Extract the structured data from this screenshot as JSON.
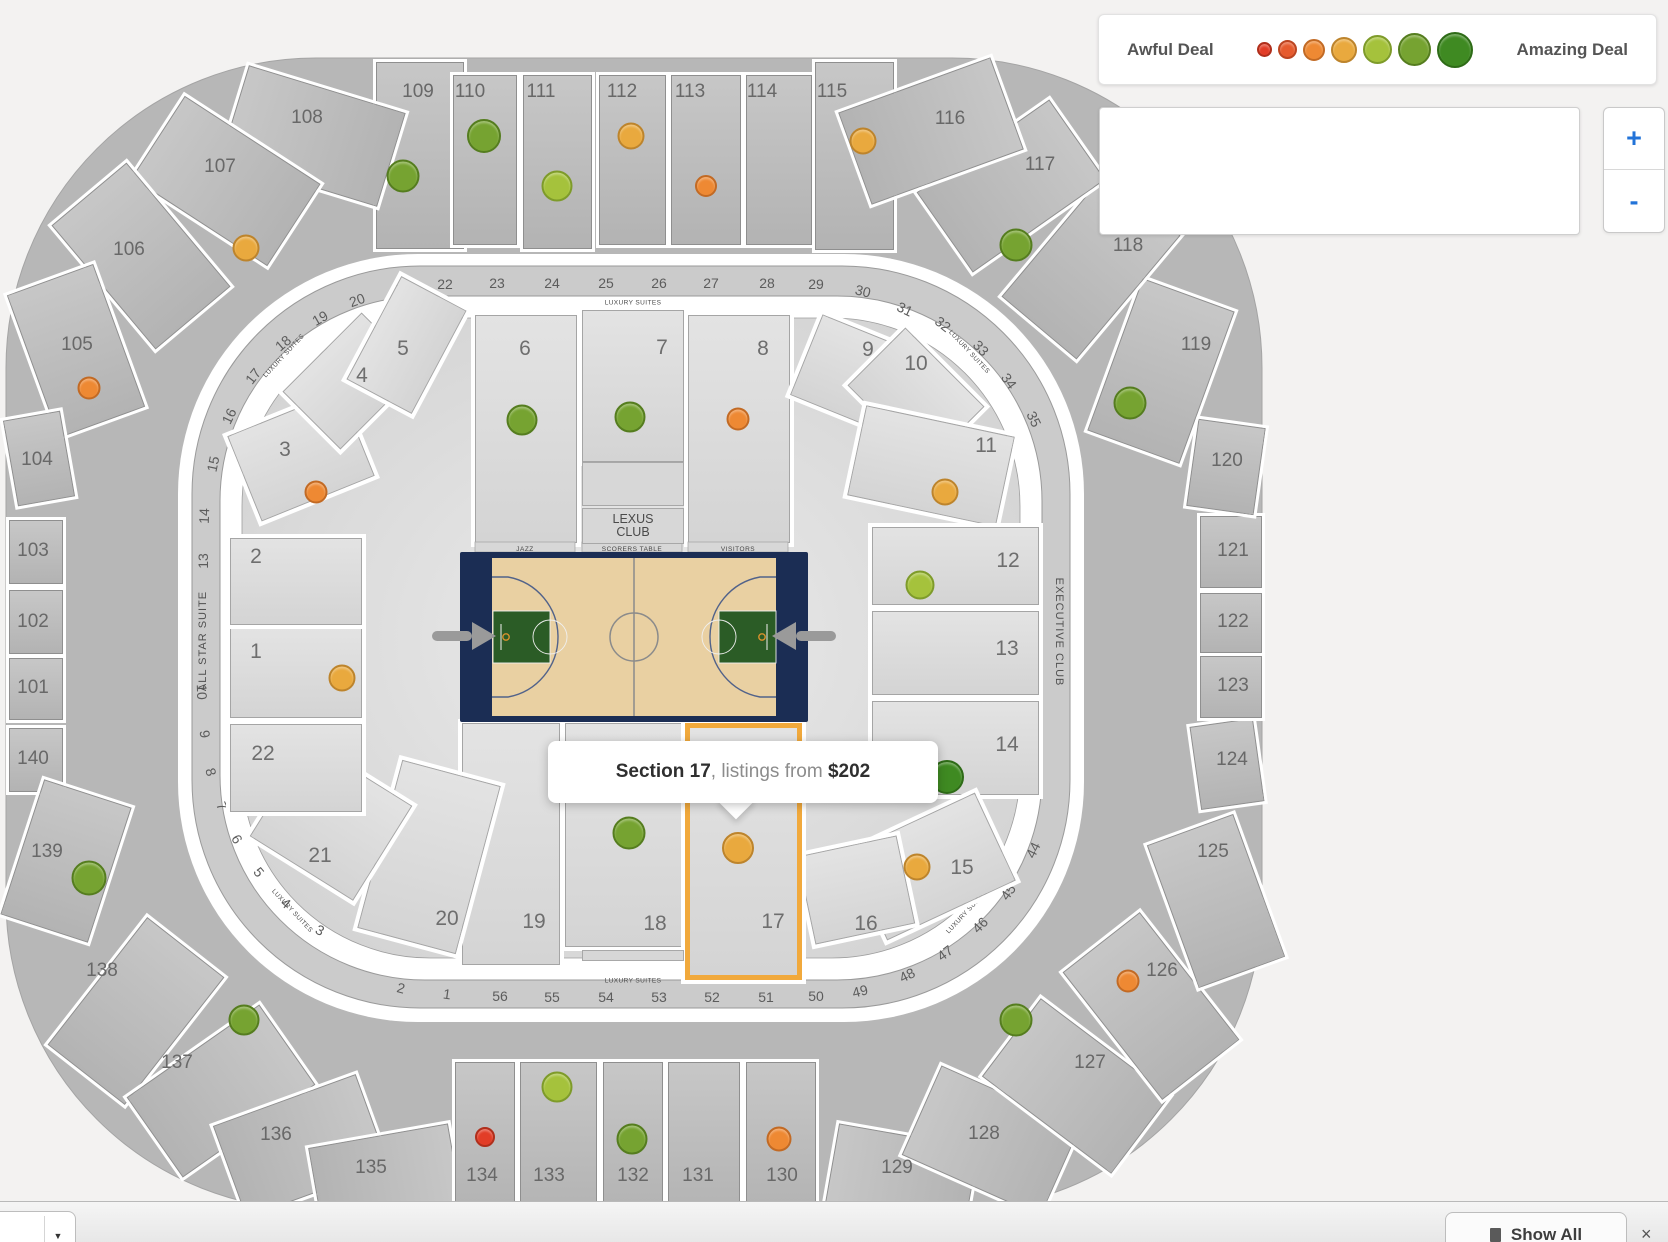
{
  "legend": {
    "awful_label": "Awful Deal",
    "amazing_label": "Amazing Deal",
    "dot_sizes": [
      11,
      15,
      18,
      22,
      25,
      29,
      32
    ]
  },
  "deal_levels": [
    {
      "bg": "#e23d27",
      "bd": "#b02f1c"
    },
    {
      "bg": "#e65b2e",
      "bd": "#bc4521"
    },
    {
      "bg": "#ee8933",
      "bd": "#c26a24"
    },
    {
      "bg": "#e9a93e",
      "bd": "#bd842c"
    },
    {
      "bg": "#a5c23c",
      "bd": "#7e9b2a"
    },
    {
      "bg": "#76a331",
      "bd": "#557d1f"
    },
    {
      "bg": "#3f8a22",
      "bd": "#2e6b17"
    }
  ],
  "colors": {
    "accent_orange": "#f1a93c",
    "zoom_blue": "#2273d8"
  },
  "controls": {
    "zoom_in": "+",
    "zoom_out": "-"
  },
  "tooltip": {
    "section": "Section 17",
    "middle": ", listings from ",
    "price": "$202"
  },
  "court": {
    "jazz": "JAZZ",
    "scorers": "SCORERS TABLE",
    "visitors": "VISITORS",
    "lexus_line1": "LEXUS",
    "lexus_line2": "CLUB"
  },
  "bottom_bar": {
    "show_all": "Show All",
    "close": "×",
    "caret": "▼"
  },
  "ring_labels": [
    {
      "t": "LUXURY SUITES",
      "x": 633,
      "y": 303,
      "r": 0,
      "c": "tiny"
    },
    {
      "t": "LUXURY SUITES",
      "x": 633,
      "y": 981,
      "r": 0,
      "c": "tiny"
    },
    {
      "t": "LUXURY SUITES",
      "x": 969,
      "y": 352,
      "r": 47,
      "c": "tiny"
    },
    {
      "t": "LUXURY SUITES",
      "x": 967,
      "y": 912,
      "r": -47,
      "c": "tiny"
    },
    {
      "t": "LUXURY SUITES",
      "x": 284,
      "y": 356,
      "r": -47,
      "c": "tiny"
    },
    {
      "t": "LUXURY SUITES",
      "x": 292,
      "y": 911,
      "r": 47,
      "c": "tiny"
    },
    {
      "t": "ALL STAR SUITE",
      "x": 203,
      "y": 641,
      "r": -90,
      "c": "vert"
    },
    {
      "t": "EXECUTIVE CLUB",
      "x": 1059,
      "y": 632,
      "r": 90,
      "c": "vert"
    }
  ],
  "suites": [
    {
      "n": "13",
      "x": 203,
      "y": 561,
      "r": -90
    },
    {
      "n": "14",
      "x": 204,
      "y": 516,
      "r": -88
    },
    {
      "n": "15",
      "x": 213,
      "y": 464,
      "r": -78
    },
    {
      "n": "16",
      "x": 229,
      "y": 416,
      "r": -64
    },
    {
      "n": "17",
      "x": 253,
      "y": 376,
      "r": -52
    },
    {
      "n": "18",
      "x": 283,
      "y": 343,
      "r": -40
    },
    {
      "n": "19",
      "x": 320,
      "y": 318,
      "r": -30
    },
    {
      "n": "20",
      "x": 357,
      "y": 300,
      "r": -20
    },
    {
      "n": "21",
      "x": 400,
      "y": 289,
      "r": -10
    },
    {
      "n": "22",
      "x": 445,
      "y": 284,
      "r": 0
    },
    {
      "n": "23",
      "x": 497,
      "y": 283,
      "r": 0
    },
    {
      "n": "24",
      "x": 552,
      "y": 283,
      "r": 0
    },
    {
      "n": "25",
      "x": 606,
      "y": 283,
      "r": 0
    },
    {
      "n": "26",
      "x": 659,
      "y": 283,
      "r": 0
    },
    {
      "n": "27",
      "x": 711,
      "y": 283,
      "r": 0
    },
    {
      "n": "28",
      "x": 767,
      "y": 283,
      "r": 0
    },
    {
      "n": "29",
      "x": 816,
      "y": 284,
      "r": 0
    },
    {
      "n": "30",
      "x": 863,
      "y": 291,
      "r": 14
    },
    {
      "n": "31",
      "x": 905,
      "y": 309,
      "r": 26
    },
    {
      "n": "32",
      "x": 943,
      "y": 324,
      "r": 38
    },
    {
      "n": "33",
      "x": 981,
      "y": 348,
      "r": 46
    },
    {
      "n": "34",
      "x": 1009,
      "y": 381,
      "r": 54
    },
    {
      "n": "35",
      "x": 1034,
      "y": 419,
      "r": 64
    },
    {
      "n": "44",
      "x": 1033,
      "y": 850,
      "r": -64
    },
    {
      "n": "45",
      "x": 1008,
      "y": 892,
      "r": -54
    },
    {
      "n": "46",
      "x": 980,
      "y": 925,
      "r": -45
    },
    {
      "n": "47",
      "x": 945,
      "y": 953,
      "r": -36
    },
    {
      "n": "48",
      "x": 907,
      "y": 975,
      "r": -26
    },
    {
      "n": "49",
      "x": 860,
      "y": 991,
      "r": -14
    },
    {
      "n": "50",
      "x": 816,
      "y": 996,
      "r": 0
    },
    {
      "n": "51",
      "x": 766,
      "y": 997,
      "r": 0
    },
    {
      "n": "52",
      "x": 712,
      "y": 997,
      "r": 0
    },
    {
      "n": "53",
      "x": 659,
      "y": 997,
      "r": 0
    },
    {
      "n": "54",
      "x": 606,
      "y": 997,
      "r": 0
    },
    {
      "n": "55",
      "x": 552,
      "y": 997,
      "r": 0
    },
    {
      "n": "56",
      "x": 500,
      "y": 996,
      "r": 0
    },
    {
      "n": "1",
      "x": 447,
      "y": 994,
      "r": 8
    },
    {
      "n": "2",
      "x": 401,
      "y": 988,
      "r": 14
    },
    {
      "n": "3",
      "x": 320,
      "y": 930,
      "r": 28
    },
    {
      "n": "4",
      "x": 286,
      "y": 903,
      "r": 40
    },
    {
      "n": "5",
      "x": 259,
      "y": 872,
      "r": 50
    },
    {
      "n": "6",
      "x": 237,
      "y": 839,
      "r": 58
    },
    {
      "n": "7",
      "x": 222,
      "y": 806,
      "r": 66
    },
    {
      "n": "8",
      "x": 211,
      "y": 772,
      "r": 74
    },
    {
      "n": "9",
      "x": 205,
      "y": 734,
      "r": 82
    },
    {
      "n": "10",
      "x": 202,
      "y": 692,
      "r": 88
    }
  ],
  "outer_sections": [
    {
      "n": "109",
      "x": 376,
      "y": 62,
      "w": 86,
      "h": 185,
      "rot": 0,
      "lx": 418,
      "ly": 92
    },
    {
      "n": "110",
      "x": 453,
      "y": 75,
      "w": 62,
      "h": 168,
      "rot": 0,
      "lx": 470,
      "ly": 92
    },
    {
      "n": "111",
      "x": 523,
      "y": 75,
      "w": 67,
      "h": 172,
      "rot": 0,
      "lx": 541,
      "ly": 92
    },
    {
      "n": "112",
      "x": 599,
      "y": 75,
      "w": 65,
      "h": 168,
      "rot": 0,
      "lx": 622,
      "ly": 92
    },
    {
      "n": "113",
      "x": 671,
      "y": 75,
      "w": 68,
      "h": 168,
      "rot": 0,
      "lx": 690,
      "ly": 92
    },
    {
      "n": "114",
      "x": 746,
      "y": 75,
      "w": 64,
      "h": 168,
      "rot": 0,
      "lx": 762,
      "ly": 92
    },
    {
      "n": "115",
      "x": 815,
      "y": 62,
      "w": 77,
      "h": 186,
      "rot": 0,
      "lx": 832,
      "ly": 92
    },
    {
      "n": "108",
      "x": 264,
      "y": 54,
      "w": 96,
      "h": 162,
      "rot": -73,
      "lx": 307,
      "ly": 118
    },
    {
      "n": "107",
      "x": 177,
      "y": 100,
      "w": 96,
      "h": 160,
      "rot": -57,
      "lx": 220,
      "ly": 167
    },
    {
      "n": "106",
      "x": 92,
      "y": 175,
      "w": 96,
      "h": 160,
      "rot": -40,
      "lx": 129,
      "ly": 250
    },
    {
      "n": "105",
      "x": 30,
      "y": 275,
      "w": 90,
      "h": 150,
      "rot": -20,
      "lx": 77,
      "ly": 345
    },
    {
      "n": "104",
      "x": 10,
      "y": 415,
      "w": 56,
      "h": 85,
      "rot": -10,
      "lx": 37,
      "ly": 460
    },
    {
      "n": "103",
      "x": 9,
      "y": 520,
      "w": 52,
      "h": 62,
      "rot": 0,
      "lx": 33,
      "ly": 551
    },
    {
      "n": "102",
      "x": 9,
      "y": 590,
      "w": 52,
      "h": 62,
      "rot": 0,
      "lx": 33,
      "ly": 622
    },
    {
      "n": "101",
      "x": 9,
      "y": 658,
      "w": 52,
      "h": 60,
      "rot": 0,
      "lx": 33,
      "ly": 688
    },
    {
      "n": "140",
      "x": 9,
      "y": 728,
      "w": 52,
      "h": 62,
      "rot": 0,
      "lx": 33,
      "ly": 759
    },
    {
      "n": "139",
      "x": 20,
      "y": 790,
      "w": 90,
      "h": 140,
      "rot": 18,
      "lx": 47,
      "ly": 852
    },
    {
      "n": "138",
      "x": 87,
      "y": 930,
      "w": 96,
      "h": 160,
      "rot": 38,
      "lx": 102,
      "ly": 971
    },
    {
      "n": "137",
      "x": 172,
      "y": 1010,
      "w": 96,
      "h": 160,
      "rot": 55,
      "lx": 177,
      "ly": 1063
    },
    {
      "n": "136",
      "x": 252,
      "y": 1070,
      "w": 96,
      "h": 150,
      "rot": 70,
      "lx": 276,
      "ly": 1135
    },
    {
      "n": "135",
      "x": 340,
      "y": 1110,
      "w": 90,
      "h": 140,
      "rot": 80,
      "lx": 371,
      "ly": 1168
    },
    {
      "n": "134",
      "x": 455,
      "y": 1062,
      "w": 58,
      "h": 148,
      "rot": 0,
      "lx": 482,
      "ly": 1176
    },
    {
      "n": "133",
      "x": 520,
      "y": 1062,
      "w": 75,
      "h": 152,
      "rot": 0,
      "lx": 549,
      "ly": 1176
    },
    {
      "n": "132",
      "x": 603,
      "y": 1062,
      "w": 58,
      "h": 148,
      "rot": 0,
      "lx": 633,
      "ly": 1176
    },
    {
      "n": "131",
      "x": 668,
      "y": 1062,
      "w": 70,
      "h": 152,
      "rot": 0,
      "lx": 698,
      "ly": 1176
    },
    {
      "n": "130",
      "x": 746,
      "y": 1062,
      "w": 68,
      "h": 148,
      "rot": 0,
      "lx": 782,
      "ly": 1176
    },
    {
      "n": "129",
      "x": 855,
      "y": 1110,
      "w": 90,
      "h": 140,
      "rot": -80,
      "lx": 897,
      "ly": 1168
    },
    {
      "n": "128",
      "x": 942,
      "y": 1065,
      "w": 96,
      "h": 150,
      "rot": -66,
      "lx": 984,
      "ly": 1134
    },
    {
      "n": "127",
      "x": 1027,
      "y": 1005,
      "w": 96,
      "h": 160,
      "rot": -53,
      "lx": 1090,
      "ly": 1063
    },
    {
      "n": "126",
      "x": 1102,
      "y": 925,
      "w": 96,
      "h": 160,
      "rot": -38,
      "lx": 1162,
      "ly": 971
    },
    {
      "n": "125",
      "x": 1170,
      "y": 825,
      "w": 90,
      "h": 150,
      "rot": -20,
      "lx": 1213,
      "ly": 852
    },
    {
      "n": "124",
      "x": 1195,
      "y": 722,
      "w": 62,
      "h": 82,
      "rot": -8,
      "lx": 1232,
      "ly": 760
    },
    {
      "n": "123",
      "x": 1200,
      "y": 656,
      "w": 60,
      "h": 60,
      "rot": 0,
      "lx": 1233,
      "ly": 686
    },
    {
      "n": "122",
      "x": 1200,
      "y": 593,
      "w": 60,
      "h": 58,
      "rot": 0,
      "lx": 1233,
      "ly": 622
    },
    {
      "n": "121",
      "x": 1200,
      "y": 516,
      "w": 60,
      "h": 70,
      "rot": 0,
      "lx": 1233,
      "ly": 551
    },
    {
      "n": "120",
      "x": 1192,
      "y": 423,
      "w": 66,
      "h": 86,
      "rot": 8,
      "lx": 1227,
      "ly": 461
    },
    {
      "n": "119",
      "x": 1112,
      "y": 290,
      "w": 96,
      "h": 160,
      "rot": 20,
      "lx": 1196,
      "ly": 345
    },
    {
      "n": "118",
      "x": 1042,
      "y": 185,
      "w": 96,
      "h": 160,
      "rot": 40,
      "lx": 1128,
      "ly": 246
    },
    {
      "n": "117",
      "x": 962,
      "y": 105,
      "w": 96,
      "h": 160,
      "rot": 55,
      "lx": 1040,
      "ly": 165
    },
    {
      "n": "116",
      "x": 882,
      "y": 50,
      "w": 96,
      "h": 160,
      "rot": 70,
      "lx": 950,
      "ly": 119
    }
  ],
  "inner_sections": [
    {
      "n": "1",
      "x": 230,
      "y": 628,
      "w": 130,
      "h": 88,
      "rot": 0,
      "lx": 256,
      "ly": 652
    },
    {
      "n": "2",
      "x": 230,
      "y": 538,
      "w": 130,
      "h": 85,
      "rot": 0,
      "lx": 256,
      "ly": 557
    },
    {
      "n": "3",
      "x": 240,
      "y": 410,
      "w": 120,
      "h": 90,
      "rot": -22,
      "lx": 285,
      "ly": 450
    },
    {
      "n": "4",
      "x": 295,
      "y": 340,
      "w": 110,
      "h": 80,
      "rot": -45,
      "lx": 362,
      "ly": 376
    },
    {
      "n": "5",
      "x": 348,
      "y": 308,
      "w": 115,
      "h": 72,
      "rot": -62,
      "lx": 403,
      "ly": 349
    },
    {
      "n": "6",
      "x": 475,
      "y": 315,
      "w": 100,
      "h": 226,
      "rot": 0,
      "lx": 525,
      "ly": 349
    },
    {
      "n": "7",
      "x": 582,
      "y": 310,
      "w": 100,
      "h": 150,
      "rot": 0,
      "lx": 662,
      "ly": 348
    },
    {
      "n": "8",
      "x": 688,
      "y": 315,
      "w": 100,
      "h": 226,
      "rot": 0,
      "lx": 763,
      "ly": 349
    },
    {
      "n": "9",
      "x": 802,
      "y": 333,
      "w": 115,
      "h": 85,
      "rot": 22,
      "lx": 868,
      "ly": 350
    },
    {
      "n": "10",
      "x": 860,
      "y": 355,
      "w": 110,
      "h": 80,
      "rot": 45,
      "lx": 916,
      "ly": 364
    },
    {
      "n": "11",
      "x": 855,
      "y": 420,
      "w": 150,
      "h": 90,
      "rot": 12,
      "lx": 986,
      "ly": 446
    },
    {
      "n": "12",
      "x": 872,
      "y": 527,
      "w": 165,
      "h": 76,
      "rot": 0,
      "lx": 1008,
      "ly": 561
    },
    {
      "n": "13",
      "x": 872,
      "y": 611,
      "w": 165,
      "h": 82,
      "rot": 0,
      "lx": 1007,
      "ly": 649
    },
    {
      "n": "14",
      "x": 872,
      "y": 701,
      "w": 165,
      "h": 92,
      "rot": 0,
      "lx": 1007,
      "ly": 745
    },
    {
      "n": "15",
      "x": 860,
      "y": 818,
      "w": 140,
      "h": 95,
      "rot": -25,
      "lx": 962,
      "ly": 868
    },
    {
      "n": "16",
      "x": 805,
      "y": 845,
      "w": 100,
      "h": 88,
      "rot": -12,
      "lx": 866,
      "ly": 924
    },
    {
      "n": "17",
      "x": 685,
      "y": 723,
      "w": 107,
      "h": 247,
      "rot": 0,
      "lx": 773,
      "ly": 922,
      "hl": true
    },
    {
      "n": "18",
      "x": 565,
      "y": 723,
      "w": 115,
      "h": 222,
      "rot": 0,
      "lx": 655,
      "ly": 924
    },
    {
      "n": "19",
      "x": 462,
      "y": 723,
      "w": 96,
      "h": 240,
      "rot": 0,
      "lx": 534,
      "ly": 922
    },
    {
      "n": "20",
      "x": 378,
      "y": 770,
      "w": 100,
      "h": 172,
      "rot": 15,
      "lx": 447,
      "ly": 919
    },
    {
      "n": "21",
      "x": 270,
      "y": 765,
      "w": 120,
      "h": 110,
      "rot": 32,
      "lx": 320,
      "ly": 856
    },
    {
      "n": "22",
      "x": 230,
      "y": 724,
      "w": 130,
      "h": 86,
      "rot": 0,
      "lx": 263,
      "ly": 754
    }
  ],
  "dots": [
    {
      "x": 403,
      "y": 176,
      "d": 29,
      "lv": 6
    },
    {
      "x": 484,
      "y": 136,
      "d": 30,
      "lv": 6
    },
    {
      "x": 557,
      "y": 186,
      "d": 27,
      "lv": 5
    },
    {
      "x": 631,
      "y": 136,
      "d": 23,
      "lv": 4
    },
    {
      "x": 706,
      "y": 186,
      "d": 18,
      "lv": 3
    },
    {
      "x": 863,
      "y": 141,
      "d": 23,
      "lv": 4
    },
    {
      "x": 246,
      "y": 248,
      "d": 23,
      "lv": 4
    },
    {
      "x": 1016,
      "y": 245,
      "d": 29,
      "lv": 6
    },
    {
      "x": 89,
      "y": 388,
      "d": 19,
      "lv": 3
    },
    {
      "x": 1130,
      "y": 403,
      "d": 29,
      "lv": 6
    },
    {
      "x": 522,
      "y": 420,
      "d": 27,
      "lv": 6
    },
    {
      "x": 630,
      "y": 417,
      "d": 27,
      "lv": 6
    },
    {
      "x": 738,
      "y": 419,
      "d": 19,
      "lv": 3
    },
    {
      "x": 316,
      "y": 492,
      "d": 19,
      "lv": 3
    },
    {
      "x": 945,
      "y": 492,
      "d": 23,
      "lv": 4
    },
    {
      "x": 920,
      "y": 585,
      "d": 25,
      "lv": 5
    },
    {
      "x": 342,
      "y": 678,
      "d": 23,
      "lv": 4
    },
    {
      "x": 89,
      "y": 878,
      "d": 31,
      "lv": 6
    },
    {
      "x": 947,
      "y": 777,
      "d": 30,
      "lv": 7
    },
    {
      "x": 629,
      "y": 833,
      "d": 29,
      "lv": 6
    },
    {
      "x": 738,
      "y": 848,
      "d": 28,
      "lv": 4
    },
    {
      "x": 917,
      "y": 867,
      "d": 23,
      "lv": 4
    },
    {
      "x": 244,
      "y": 1020,
      "d": 27,
      "lv": 6
    },
    {
      "x": 1016,
      "y": 1020,
      "d": 29,
      "lv": 6
    },
    {
      "x": 1128,
      "y": 981,
      "d": 19,
      "lv": 3
    },
    {
      "x": 557,
      "y": 1087,
      "d": 27,
      "lv": 5
    },
    {
      "x": 485,
      "y": 1137,
      "d": 16,
      "lv": 1
    },
    {
      "x": 632,
      "y": 1139,
      "d": 27,
      "lv": 6
    },
    {
      "x": 779,
      "y": 1139,
      "d": 21,
      "lv": 3
    }
  ]
}
